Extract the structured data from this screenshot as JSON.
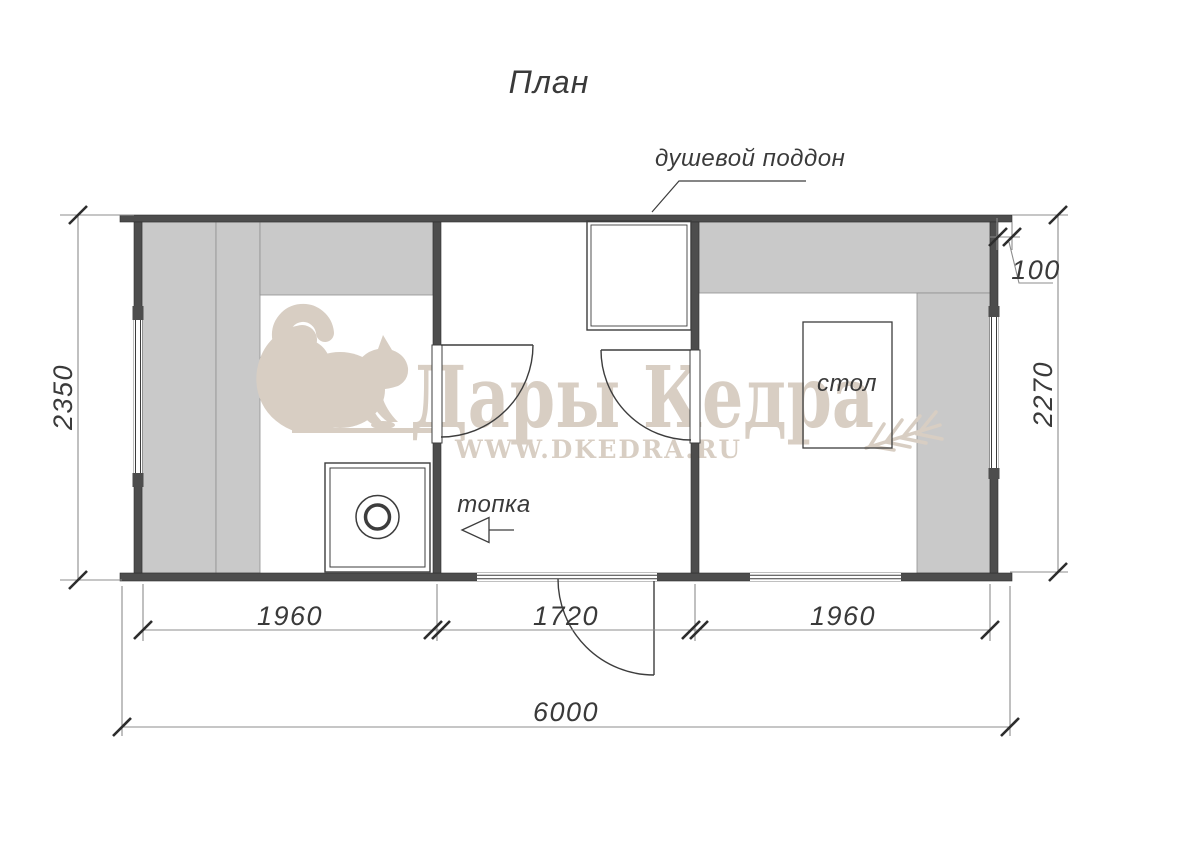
{
  "title": "План",
  "annotations": {
    "shower_tray": "душевой поддон",
    "firebox": "топка",
    "table": "стол"
  },
  "dimensions": {
    "left_height": "2350",
    "right_height": "2270",
    "wall_overhang": "100",
    "bay_left": "1960",
    "bay_middle": "1720",
    "bay_right": "1960",
    "total_width": "6000"
  },
  "watermark": {
    "brand": "Дары Кедра",
    "website": "WWW.DKEDRA.RU"
  },
  "colors": {
    "wall": "#4d4d4d",
    "bench": "#c9c9c9",
    "outline": "#3d3d3d",
    "dimension_line": "#8c8c8c",
    "tick": "#2d2d2d",
    "watermark": "#d8cec3"
  }
}
